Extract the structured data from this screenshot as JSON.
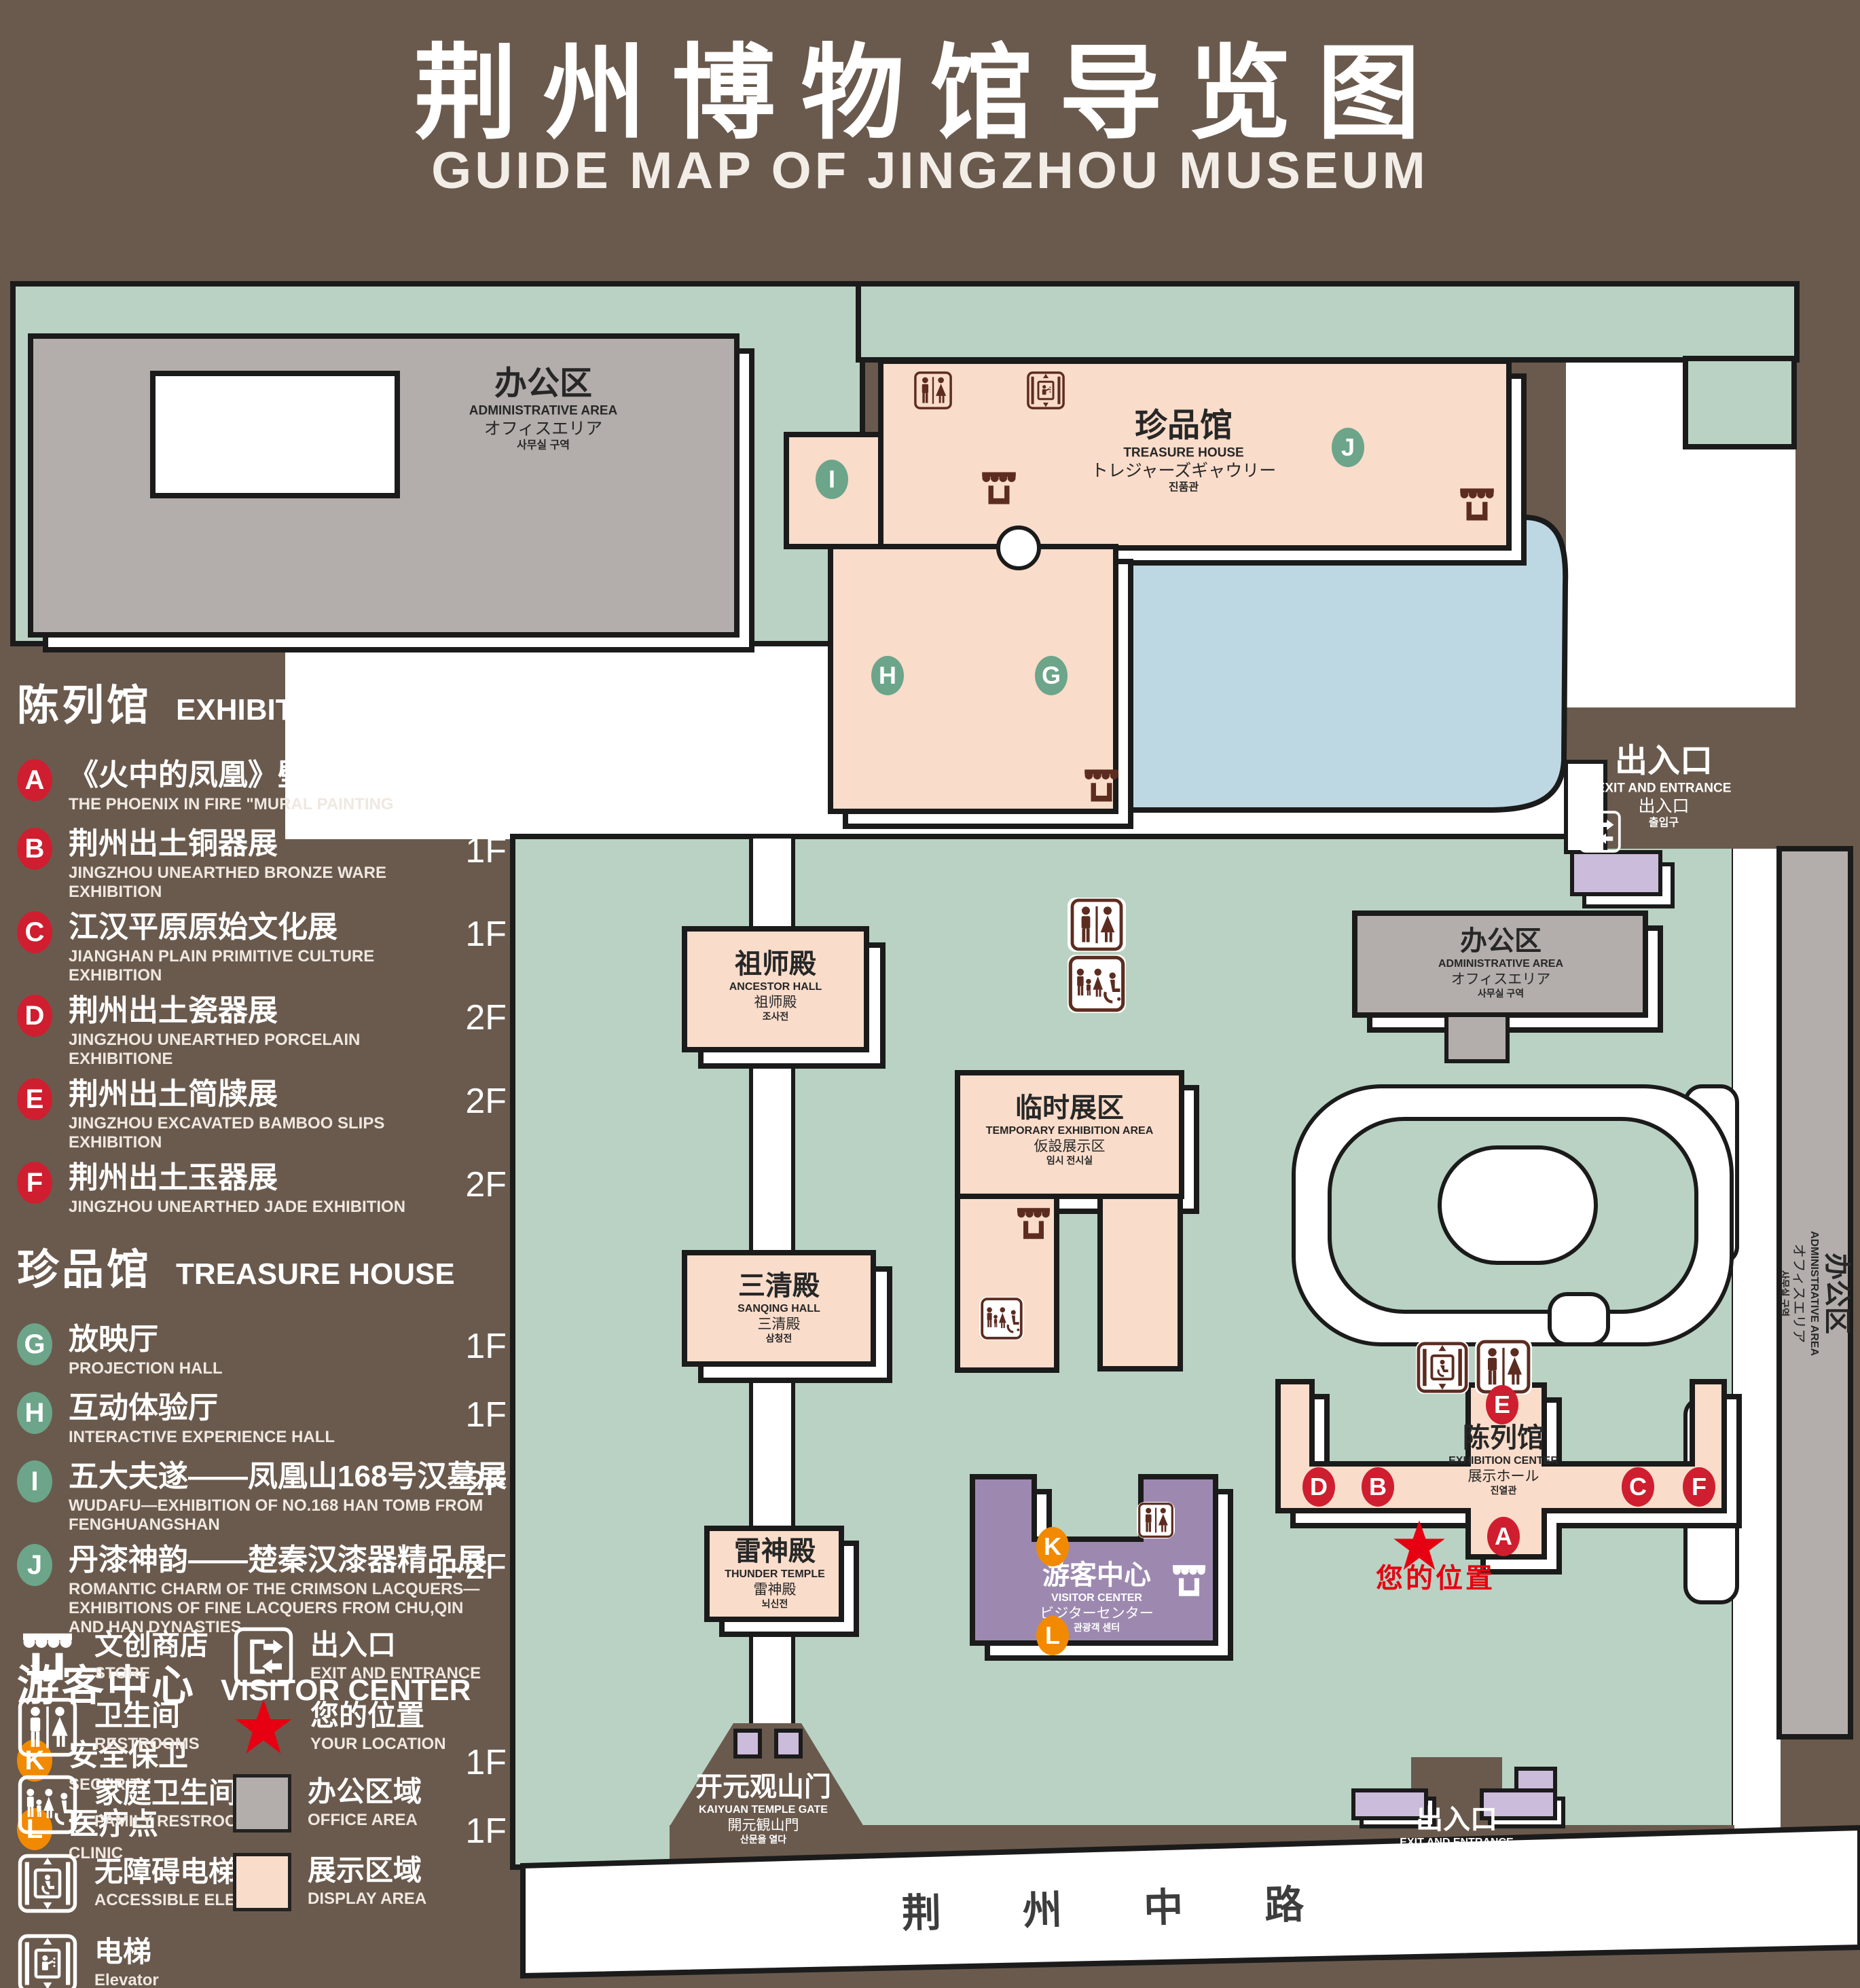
{
  "title": {
    "zh": "荆州博物馆导览图",
    "en": "GUIDE MAP OF JINGZHOU MUSEUM"
  },
  "colors": {
    "background": "#6a5a4d",
    "green_area": "#b9d2c3",
    "display_area": "#f9dcca",
    "office_area": "#b3aeab",
    "pond": "#bdd8e3",
    "visitor_center": "#9d89b0",
    "small_building": "#cbbcdb",
    "badge_red": "#cf1e2f",
    "badge_green": "#6ca58a",
    "badge_orange": "#f18a00",
    "icon_brown": "#5d2c20",
    "location_red": "#e60012",
    "outline": "#1b1b1b"
  },
  "legend": {
    "sections": [
      {
        "zh": "陈列馆",
        "en": "EXHIBITION CENTER",
        "badge": "red",
        "items": [
          {
            "letter": "A",
            "zh": "《火中的凤凰》壁画",
            "en": "THE PHOENIX IN FIRE \"MURAL PAINTING",
            "floor": "1F"
          },
          {
            "letter": "B",
            "zh": "荆州出土铜器展",
            "en": "JINGZHOU UNEARTHED BRONZE WARE EXHIBITION",
            "floor": "1F"
          },
          {
            "letter": "C",
            "zh": "江汉平原原始文化展",
            "en": "JIANGHAN PLAIN PRIMITIVE CULTURE EXHIBITION",
            "floor": "1F"
          },
          {
            "letter": "D",
            "zh": "荆州出土瓷器展",
            "en": "JINGZHOU UNEARTHED PORCELAIN EXHIBITIONE",
            "floor": "2F"
          },
          {
            "letter": "E",
            "zh": "荆州出土简牍展",
            "en": "JINGZHOU EXCAVATED BAMBOO SLIPS EXHIBITION",
            "floor": "2F"
          },
          {
            "letter": "F",
            "zh": "荆州出土玉器展",
            "en": "JINGZHOU UNEARTHED JADE EXHIBITION",
            "floor": "2F"
          }
        ]
      },
      {
        "zh": "珍品馆",
        "en": "TREASURE HOUSE",
        "badge": "green",
        "items": [
          {
            "letter": "G",
            "zh": "放映厅",
            "en": "PROJECTION HALL",
            "floor": "1F"
          },
          {
            "letter": "H",
            "zh": "互动体验厅",
            "en": "INTERACTIVE EXPERIENCE HALL",
            "floor": "1F"
          },
          {
            "letter": "I",
            "zh": "五大夫遂——凤凰山168号汉墓展",
            "en": "WUDAFU—EXHIBITION OF NO.168 HAN TOMB FROM FENGHUANGSHAN",
            "floor": "2F"
          },
          {
            "letter": "J",
            "zh": "丹漆神韵——楚秦汉漆器精品展",
            "en": "ROMANTIC CHARM OF THE CRIMSON LACQUERS—EXHIBITIONS OF FINE LACQUERS FROM CHU,QIN AND HAN DYNASTIES",
            "floor": "1-2F"
          }
        ]
      },
      {
        "zh": "游客中心",
        "en": "VISITOR CENTER",
        "badge": "orange",
        "items": [
          {
            "letter": "K",
            "zh": "安全保卫",
            "en": "SECURITY",
            "floor": "1F"
          },
          {
            "letter": "L",
            "zh": "医疗点",
            "en": "CLINIC",
            "floor": "1F"
          }
        ]
      }
    ],
    "symbols": [
      {
        "icon": "store",
        "zh": "文创商店",
        "en": "STORE"
      },
      {
        "icon": "restroom",
        "zh": "卫生间",
        "en": "RESTROOMS"
      },
      {
        "icon": "family-restroom",
        "zh": "家庭卫生间",
        "en": "FAMILY RESTROOMS"
      },
      {
        "icon": "accessible-elevator",
        "zh": "无障碍电梯",
        "en": "ACCESSIBLE ELEVATOR"
      },
      {
        "icon": "elevator",
        "zh": "电梯",
        "en": "Elevator"
      },
      {
        "icon": "exit",
        "zh": "出入口",
        "en": "EXIT AND ENTRANCE"
      },
      {
        "icon": "location-star",
        "zh": "您的位置",
        "en": "YOUR LOCATION"
      },
      {
        "icon": "swatch-office",
        "zh": "办公区域",
        "en": "OFFICE AREA"
      },
      {
        "icon": "swatch-display",
        "zh": "展示区域",
        "en": "DISPLAY AREA"
      }
    ]
  },
  "map": {
    "admin": {
      "zh": "办公区",
      "en": "ADMINISTRATIVE AREA",
      "ja": "オフィスエリア",
      "ko": "사무실 구역"
    },
    "treasure_house": {
      "zh": "珍品馆",
      "en": "TREASURE HOUSE",
      "ja": "トレジャーズギャウリー",
      "ko": "진품관",
      "badges": [
        "I",
        "J",
        "H",
        "G"
      ]
    },
    "exit": {
      "zh": "出入口",
      "en": "EXIT AND ENTRANCE",
      "ja": "出入口",
      "ko": "출입구"
    },
    "ancestor_hall": {
      "zh": "祖师殿",
      "en": "ANCESTOR HALL",
      "ja": "祖师殿",
      "ko": "조사전"
    },
    "temporary_area": {
      "zh": "临时展区",
      "en": "TEMPORARY EXHIBITION AREA",
      "ja": "仮設展示区",
      "ko": "임시 전시실"
    },
    "sanqing_hall": {
      "zh": "三清殿",
      "en": "SANQING HALL",
      "ja": "三清殿",
      "ko": "삼청전"
    },
    "thunder_temple": {
      "zh": "雷神殿",
      "en": "THUNDER TEMPLE",
      "ja": "雷神殿",
      "ko": "뇌신전"
    },
    "exhibition_center": {
      "zh": "陈列馆",
      "en": "EXHIBITION CENTER",
      "ja": "展示ホール",
      "ko": "진열관",
      "badges": [
        "E",
        "D",
        "B",
        "A",
        "C",
        "F"
      ]
    },
    "visitor_center": {
      "zh": "游客中心",
      "en": "VISITOR CENTER",
      "ja": "ビジターセンター",
      "ko": "관광객 센터",
      "badges": [
        "K",
        "L"
      ]
    },
    "gate": {
      "zh": "开元观山门",
      "en": "KAIYUAN TEMPLE GATE",
      "ja": "開元観山門",
      "ko": "산문을 열다"
    },
    "road": {
      "zh": "荆 州 中 路"
    },
    "your_location": "您的位置"
  }
}
